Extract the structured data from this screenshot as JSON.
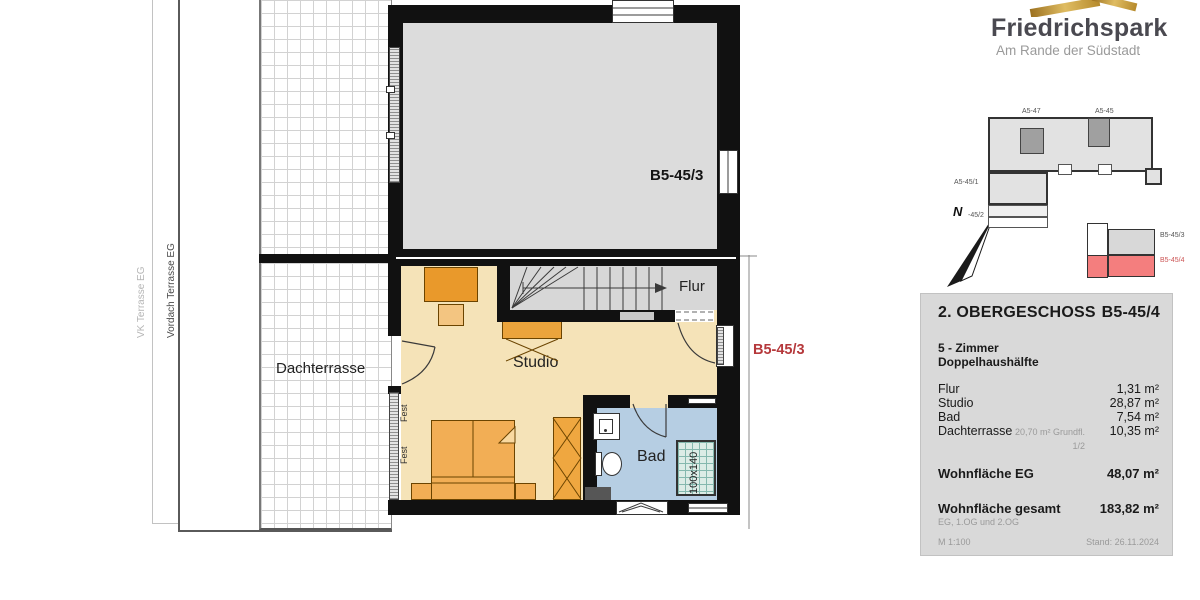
{
  "logo": {
    "title": "Friedrichspark",
    "subtitle": "Am Rande der Südstadt",
    "gold_color": "#c8a04a"
  },
  "site_plan": {
    "building_labels": {
      "top_left": "A5-47",
      "top_right": "A5-45",
      "left": "A5-45/1",
      "north_adjacent": "-45/2"
    },
    "north_letter": "N",
    "key_plan": {
      "upper": "B5-45/3",
      "lower": "B5-45/4",
      "highlight_color": "#f47e7e"
    }
  },
  "plan": {
    "terrace_labels": {
      "outer": "VK Terrasse EG",
      "inner": "Vordach Terrasse EG"
    },
    "rooms": {
      "dachterrasse": "Dachterrasse",
      "flur": "Flur",
      "studio": "Studio",
      "bad": "Bad"
    },
    "neighbor_unit_label": "B5-45/3",
    "adjacent_unit_label": "B5-45/3",
    "adjacent_label_color": "#b5383b",
    "shower_size": "100x140",
    "fixed_window_label": "Fest",
    "colors": {
      "wall": "#111111",
      "studio_floor": "#f5e3b8",
      "bad_floor": "#b6cee3",
      "furniture_orange": "#f2ae55",
      "stairs_gray": "#d7d7d7",
      "neighbor_room_gray": "#dcdcdc"
    }
  },
  "info_panel": {
    "floor_title": "2. OBERGESCHOSS",
    "unit_title": "B5-45/4",
    "type_lines": [
      "5 - Zimmer",
      "Doppelhaushälfte"
    ],
    "areas": [
      {
        "label": "Flur",
        "note": "",
        "value": "1,31 m²"
      },
      {
        "label": "Studio",
        "note": "",
        "value": "28,87 m²"
      },
      {
        "label": "Bad",
        "note": "",
        "value": "7,54 m²"
      },
      {
        "label": "Dachterrasse",
        "note": "20,70 m² Grundfl. 1/2",
        "value": "10,35 m²"
      }
    ],
    "totals": [
      {
        "label": "Wohnfläche EG",
        "note": "",
        "value": "48,07 m²"
      },
      {
        "label": "Wohnfläche gesamt",
        "note": "EG, 1.OG und 2.OG",
        "value": "183,82 m²"
      }
    ],
    "scale": "M 1:100",
    "date": "Stand: 26.11.2024"
  }
}
